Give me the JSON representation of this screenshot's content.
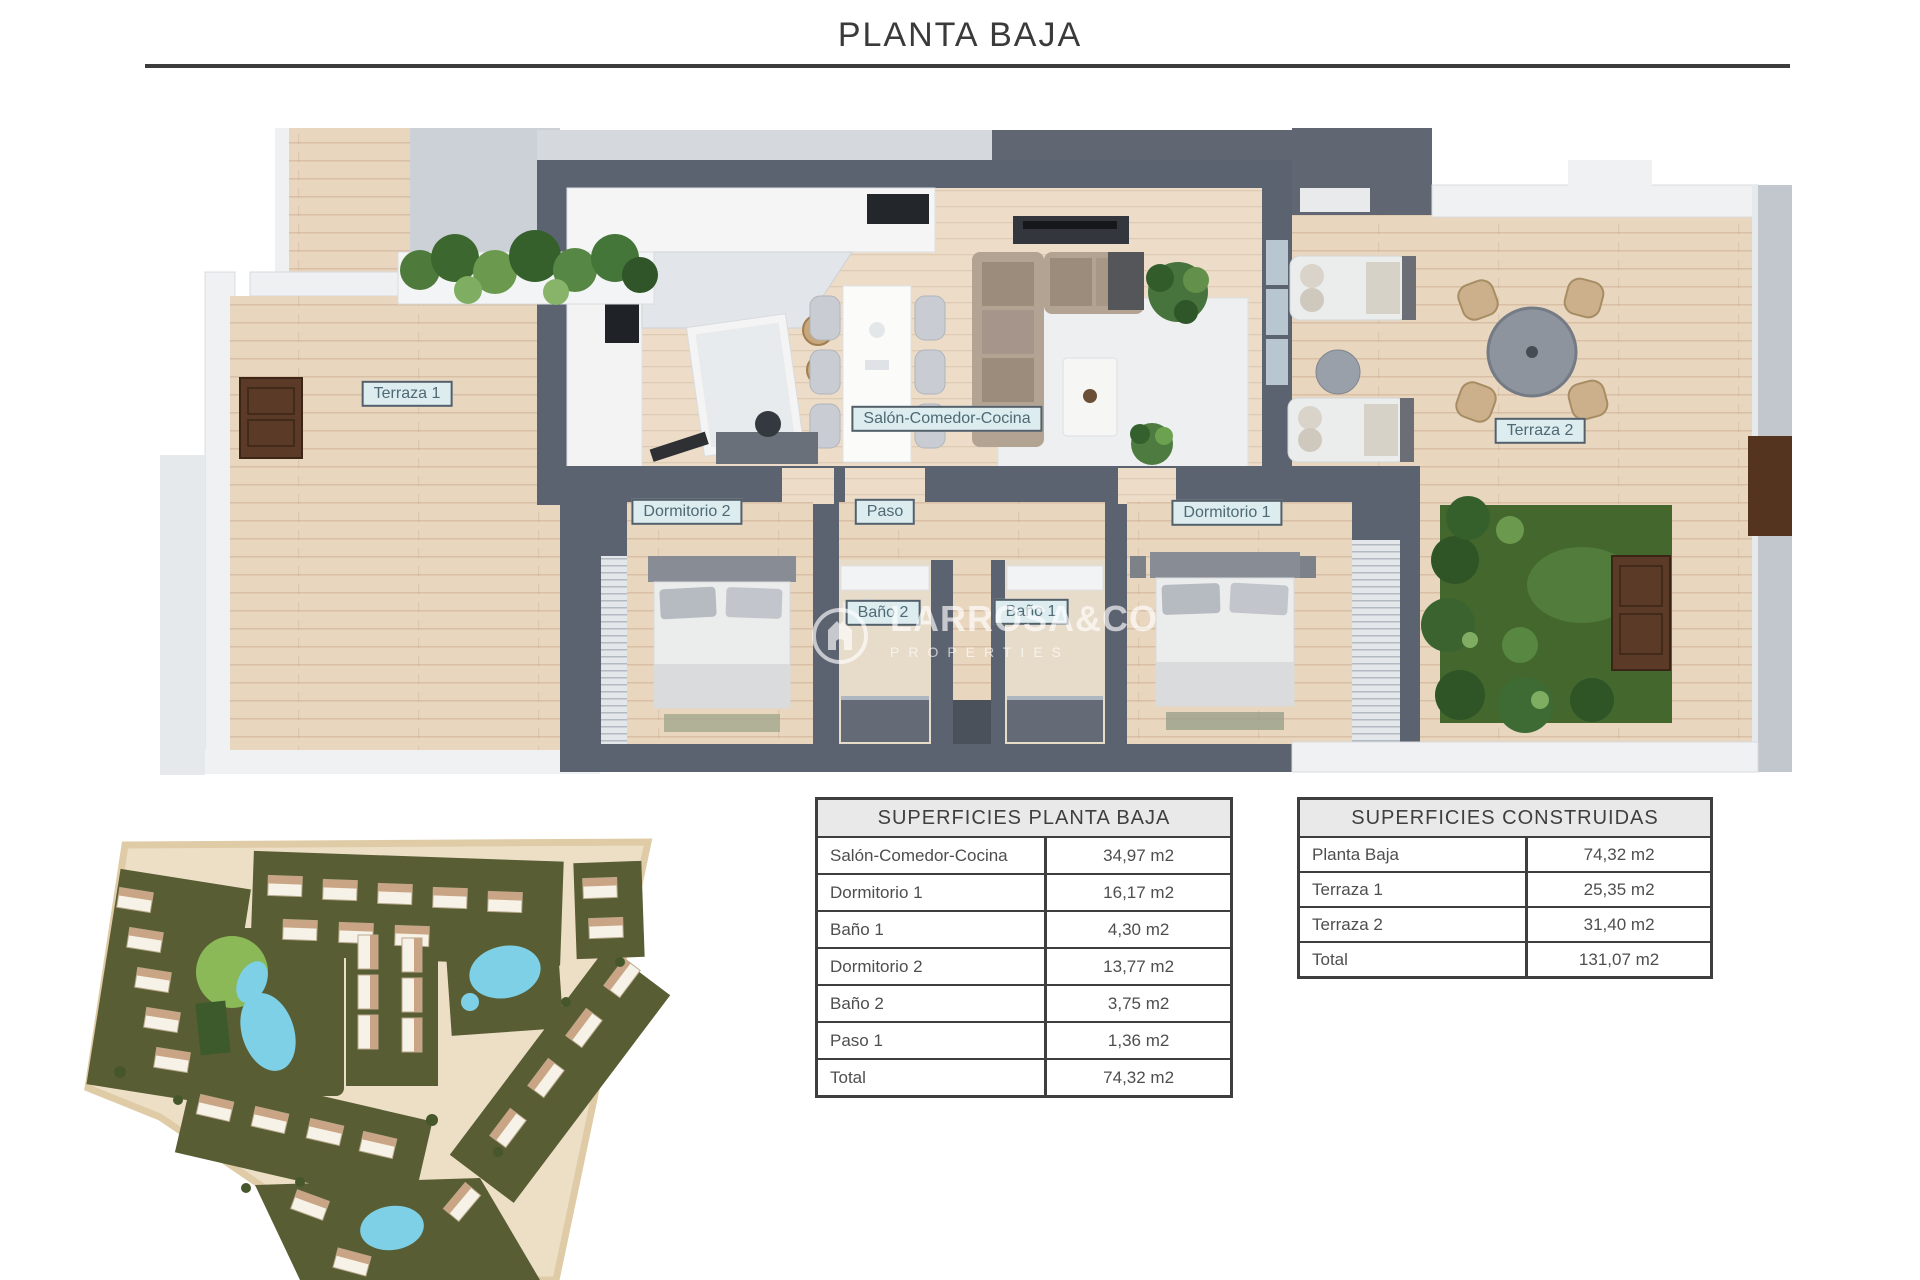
{
  "title": "PLANTA BAJA",
  "floor_plan": {
    "room_labels": {
      "terraza1": "Terraza 1",
      "salon": "Salón-Comedor-Cocina",
      "dormitorio2": "Dormitorio 2",
      "paso": "Paso",
      "dormitorio1": "Dormitorio 1",
      "bano2": "Baño 2",
      "bano1": "Baño 1",
      "terraza2": "Terraza 2"
    }
  },
  "watermark": {
    "brand": "LARROSA&CO",
    "subtitle": "PROPERTIES"
  },
  "tables": {
    "superficies_planta_baja": {
      "title": "SUPERFICIES PLANTA BAJA",
      "rows": [
        {
          "label": "Salón-Comedor-Cocina",
          "value": "34,97 m2"
        },
        {
          "label": "Dormitorio 1",
          "value": "16,17 m2"
        },
        {
          "label": "Baño 1",
          "value": "4,30 m2"
        },
        {
          "label": "Dormitorio 2",
          "value": "13,77 m2"
        },
        {
          "label": "Baño 2",
          "value": "3,75 m2"
        },
        {
          "label": "Paso 1",
          "value": "1,36 m2"
        },
        {
          "label": "Total",
          "value": "74,32 m2"
        }
      ]
    },
    "superficies_construidas": {
      "title": "SUPERFICIES CONSTRUIDAS",
      "rows": [
        {
          "label": "Planta Baja",
          "value": "74,32 m2"
        },
        {
          "label": "Terraza 1",
          "value": "25,35 m2"
        },
        {
          "label": "Terraza 2",
          "value": "31,40 m2"
        },
        {
          "label": "Total",
          "value": "131,07 m2"
        }
      ]
    }
  },
  "colors": {
    "wall_dark": "#5c6370",
    "wood_floor": "#e9d6bf",
    "label_bg": "#dcecef",
    "garden_green": "#44672e",
    "pool_blue": "#7ed0e6",
    "site_cream": "#ecdfc6",
    "title_text": "#3a3a3a"
  }
}
